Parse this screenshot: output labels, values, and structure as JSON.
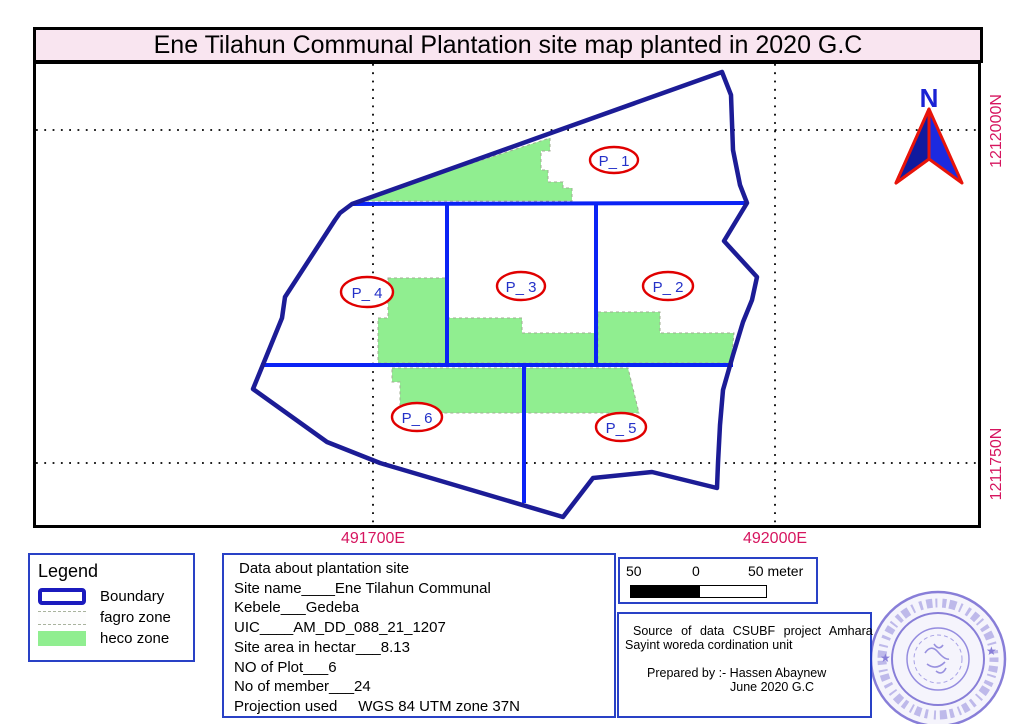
{
  "title": "Ene Tilahun Communal Plantation site map planted in 2020 G.C",
  "map": {
    "north_arrow_label": "N",
    "plots": [
      {
        "label": "P_ 1"
      },
      {
        "label": "P_ 2"
      },
      {
        "label": "P_ 3"
      },
      {
        "label": "P_ 4"
      },
      {
        "label": "P_ 5"
      },
      {
        "label": "P_ 6"
      }
    ],
    "grid_labels": {
      "east": [
        {
          "label": "491700E"
        },
        {
          "label": "492000E"
        }
      ],
      "north": [
        {
          "label": "1212000N"
        },
        {
          "label": "1211750N"
        }
      ]
    }
  },
  "legend": {
    "title": "Legend",
    "items": [
      {
        "label": "Boundary",
        "type": "boundary"
      },
      {
        "label": "fagro zone",
        "type": "fagro"
      },
      {
        "label": "heco zone",
        "type": "heco"
      }
    ]
  },
  "data_box": {
    "lines": [
      "Data about plantation site",
      "Site name____Ene Tilahun Communal",
      "Kebele___Gedeba",
      "UIC____AM_DD_088_21_1207",
      "Site area in hectar___8.13",
      "NO of Plot___6",
      "No of member___24",
      "Projection used     WGS 84 UTM zone 37N"
    ]
  },
  "scale_bar": {
    "left": "50",
    "center": "0",
    "right": "50 meter"
  },
  "source_box": {
    "line1": "Source of data CSUBF project Amhara",
    "line2": "Sayint woreda cordination unit",
    "prepared_by": "Prepared by :- Hassen Abaynew",
    "date": "June 2020 G.C"
  },
  "colors": {
    "title_bg": "#f9e5f0",
    "boundary": "#1c1c96",
    "plot_divider": "#0a23f5",
    "heco_zone": "#90ee90",
    "fagro_dash": "#a0ac93",
    "plot_oval": "#e00000",
    "plot_text": "#2431c8",
    "grid_label": "#d6155f",
    "box_border": "#2941c6",
    "stamp": "#6b5fcf",
    "north_arrow_fill": "#1b2ae0",
    "north_arrow_outline": "#e8140a"
  }
}
